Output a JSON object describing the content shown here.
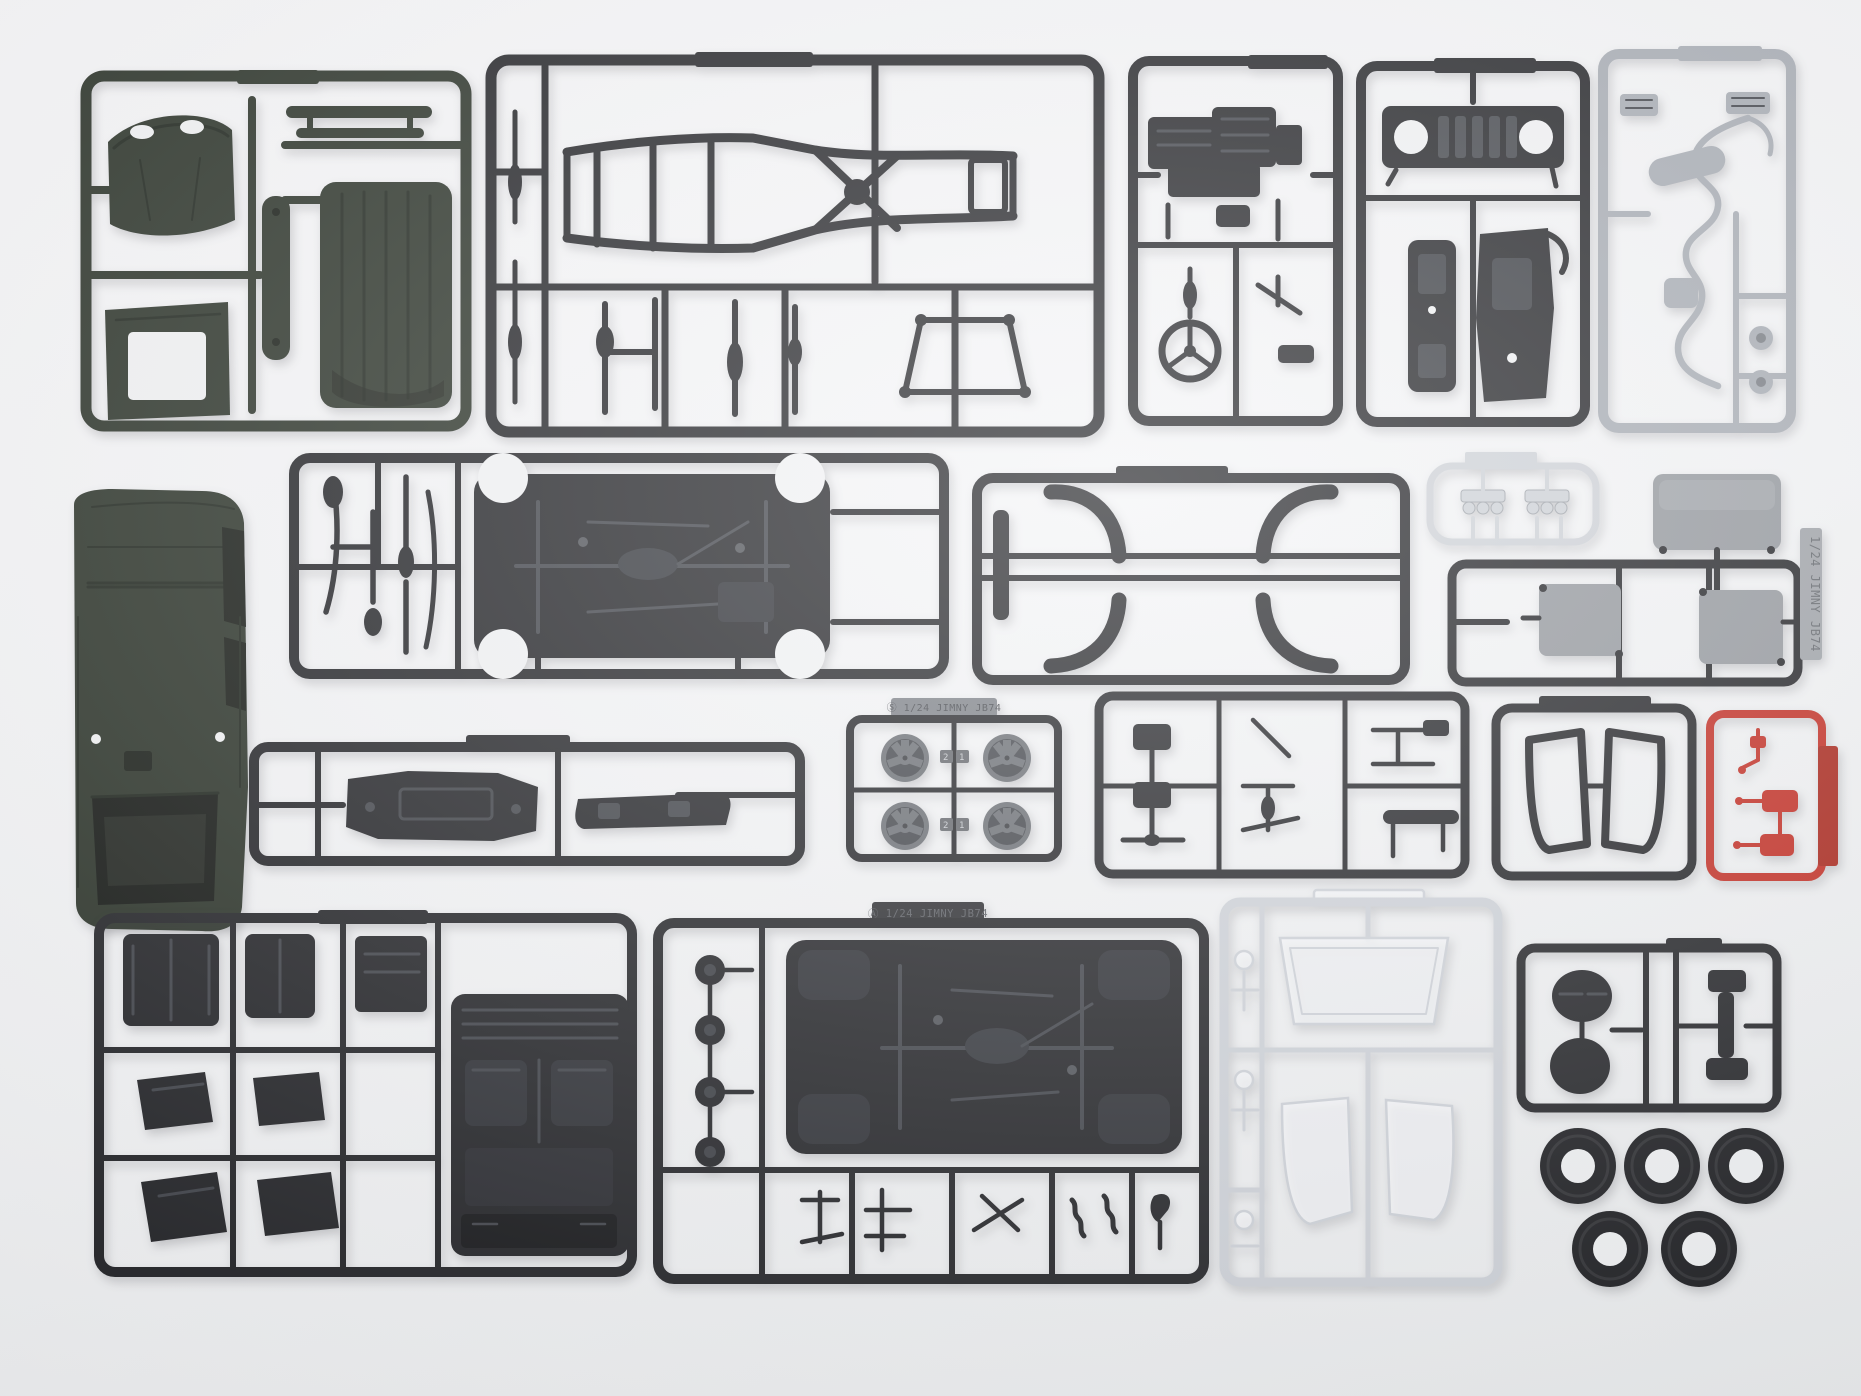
{
  "scene": {
    "description": "Overhead photo of an unassembled 1/24 scale Suzuki Jimny JB74 plastic model kit: twenty injection-molded sprues, a dark-green body shell, five rubber tires and clear window parts laid out in rows on a white surface",
    "background_color": "#f2f3f5"
  },
  "colors": {
    "dark_green": "#242c22",
    "green_shadow": "#10150f",
    "black_plastic": "#1b1c20",
    "black_detail": "#33363c",
    "gray_plastic": "#a4a9b1",
    "chrome_silver": "#ccd0d6",
    "metal_gray": "#90949a",
    "red_plastic": "#c0251b",
    "red_tag": "#a61d12",
    "clear_stroke": "#ccd0d7",
    "tire_black": "#141519",
    "wheel_gray": "#64686e",
    "tag_gray_bg": "#787c83",
    "tag_gray_text": "#3c3f45",
    "tag_black_bg": "#232428",
    "tag_black_text": "#56595f",
    "tag_metal_bg": "#9b9fa5",
    "tag_metal_text": "#5c6066"
  },
  "tags": {
    "wheel_sprue": "Ⓢ 1/24 JIMNY JB74",
    "chassis_sprue": "Ⓐ 1/24 JIMNY JB74",
    "window_sprue_vertical": "1/24 JIMNY JB74",
    "wheel_marks": [
      "2",
      "1"
    ]
  },
  "sprues": [
    {
      "id": "body-panels-green",
      "color": "dark_green",
      "description": "hood, ribbed roof panel, windscreen frame, front panel"
    },
    {
      "id": "chassis-frame",
      "color": "black_plastic",
      "description": "ladder chassis frame with X cross-member, suspension links"
    },
    {
      "id": "engine",
      "color": "black_plastic",
      "description": "engine block halves, steering wheel, column"
    },
    {
      "id": "grille-bumpers",
      "color": "black_plastic",
      "description": "front grille with round headlamp holes, front and rear bumpers"
    },
    {
      "id": "exhaust-gray",
      "color": "gray_plastic",
      "description": "exhaust pipe, muffler, resonator, two brake discs"
    },
    {
      "id": "body-shell",
      "color": "dark_green",
      "description": "one-piece Jimny body shell, roof up"
    },
    {
      "id": "underbody-suspension",
      "color": "black_plastic",
      "description": "floor pan with drivetrain, suspension arms"
    },
    {
      "id": "fender-flares",
      "color": "black_plastic",
      "description": "four C-shaped wheel-arch flares"
    },
    {
      "id": "chrome-lights",
      "color": "chrome_silver",
      "description": "two clusters of three chromed lamp bezels"
    },
    {
      "id": "window-masks",
      "color": "metal_gray",
      "description": "gray glazing masks with vertical JB74 tag"
    },
    {
      "id": "bumper-valance",
      "color": "black_plastic",
      "description": "front bumper and valance bar"
    },
    {
      "id": "wheels",
      "color": "wheel_gray",
      "description": "four five-spoke wheels, position marks 2 and 1, Ⓢ tag"
    },
    {
      "id": "small-parts-b",
      "color": "black_plastic",
      "description": "hinges, levers, wipers, door handles"
    },
    {
      "id": "door-frames",
      "color": "black_plastic",
      "description": "two door window frames"
    },
    {
      "id": "tail-lights-red",
      "color": "red_plastic",
      "description": "red tail-lamp lenses with molded tag"
    },
    {
      "id": "seats-interior",
      "color": "black_plastic",
      "description": "seat backs, bench, four seat bases, interior tub"
    },
    {
      "id": "chassis-a",
      "color": "black_plastic",
      "description": "second floor pan, four brake backing plates, axle parts, Ⓐ tag"
    },
    {
      "id": "clear-windows",
      "color": "clear_stroke",
      "description": "windshield and side window clear parts"
    },
    {
      "id": "spare-wheel",
      "color": "black_plastic",
      "description": "spare-wheel cover discs and tailgate hinge"
    },
    {
      "id": "tires",
      "color": "tire_black",
      "description": "five rubber tires, three plus two"
    }
  ]
}
